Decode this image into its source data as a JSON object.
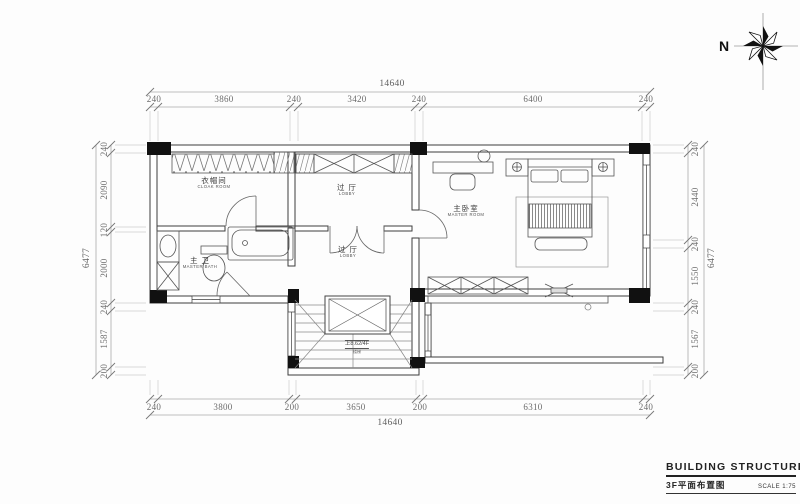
{
  "compass": {
    "north_label": "N"
  },
  "rooms": {
    "cloak": {
      "name_cn": "衣帽间",
      "name_en": "CLOAK ROOM"
    },
    "lobby_upper": {
      "name_cn": "过 厅",
      "name_en": "LOBBY"
    },
    "lobby_lower": {
      "name_cn": "过 厅",
      "name_en": "LOBBY"
    },
    "master_bath": {
      "name_cn": "主 卫",
      "name_en": "MASTER BATH"
    },
    "master_bed": {
      "name_cn": "主卧室",
      "name_en": "MASTER ROOM"
    }
  },
  "stairs": {
    "note": "上8.62/4F",
    "sub_note": "楼梯"
  },
  "dimensions": {
    "top": {
      "total": "14640",
      "segments": [
        "240",
        "3860",
        "240",
        "3420",
        "240",
        "6400",
        "240"
      ]
    },
    "bottom": {
      "total": "14640",
      "segments": [
        "240",
        "3800",
        "200",
        "3650",
        "200",
        "6310",
        "240"
      ]
    },
    "left": {
      "total": "6477",
      "segments": [
        "240",
        "2090",
        "120",
        "2000",
        "240",
        "1587",
        "200"
      ]
    },
    "right": {
      "total": "6477",
      "segments": [
        "240",
        "2440",
        "240",
        "1550",
        "240",
        "1567",
        "200"
      ]
    }
  },
  "title_block": {
    "title": "BUILDING STRUCTURE",
    "drawing_name": "3F平面布置图",
    "scale": "SCALE 1:75"
  }
}
